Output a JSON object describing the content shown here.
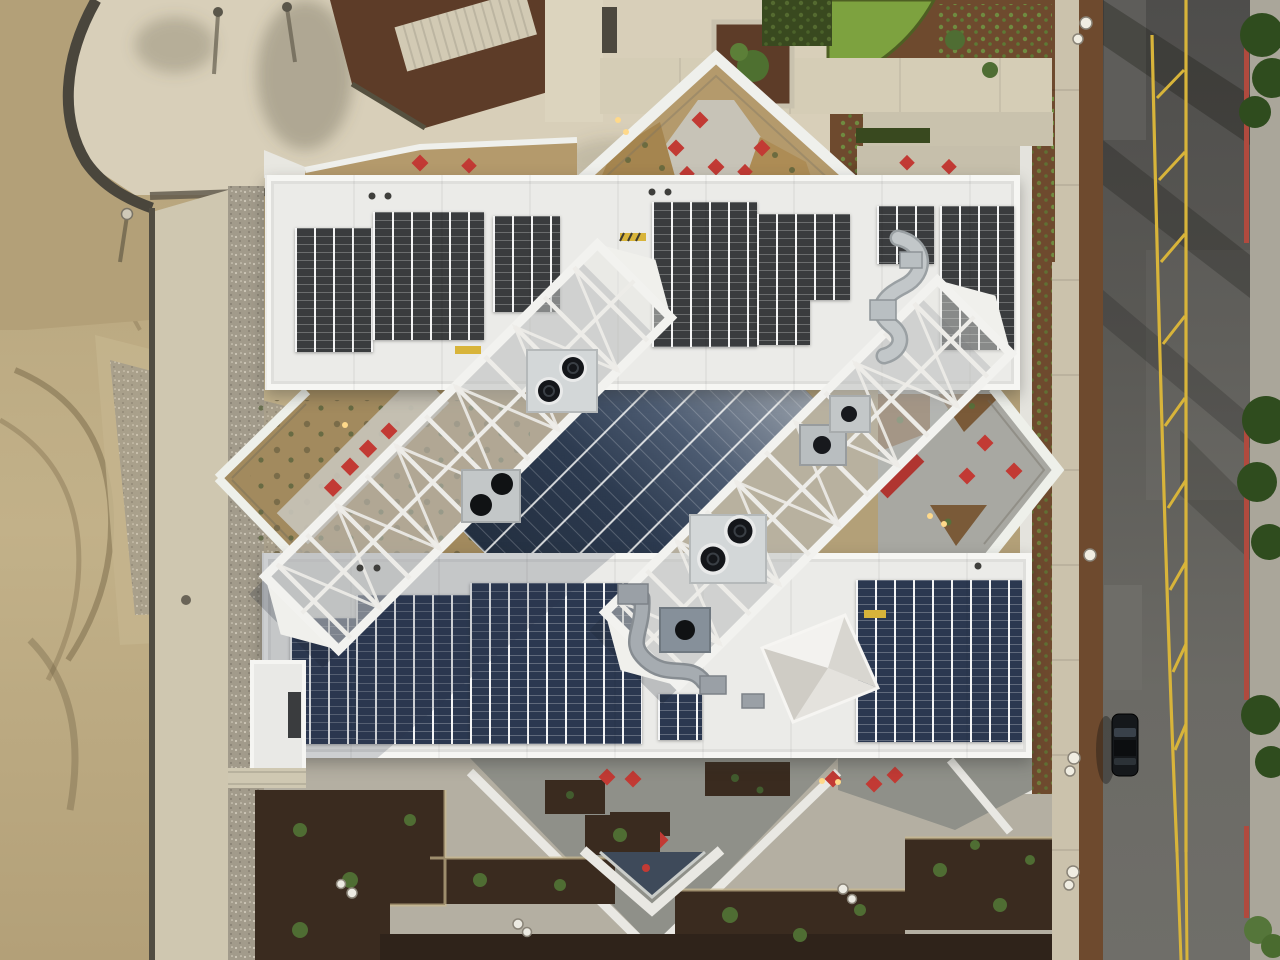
{
  "meta": {
    "type": "aerial-photograph",
    "subject": "Top-down drone photo of a white office building rooftop with solar panel arrays, two diagonal rooftop trusses over a dark glass atrium, landscaped terraces with red umbrellas, a dirt construction lot on the left and a street with yellow median markings and one parked dark car on the right",
    "view": "nadir (straight down)"
  },
  "palette": {
    "dirt": "#b3a078",
    "dirtLight": "#c2b189",
    "wall": "#4a463c",
    "plaza": "#d8cfb9",
    "plazaDusk": "#b4afa2",
    "walk": "#cfc7b0",
    "walk2": "#cbc2ac",
    "gravel": "#a29b8b",
    "mulch": "#5d3c28",
    "mulch2": "#6e4a2e",
    "mulchDusk": "#3a2b1f",
    "lawn": "#7da23f",
    "hedge": "#39491f",
    "tree": "#2f4c1e",
    "tree2": "#4e7030",
    "shrub": "#4f6d33",
    "road1": "#4e4d4b",
    "road2": "#6b6a65",
    "yellow": "#d8b43a",
    "curb": "#b04a3e",
    "roof": "#ebebe8",
    "roofEdge": "#f6f6f3",
    "panelDark": "#3a3c3e",
    "panelBlue": "#2b3850",
    "glass1": "#232f40",
    "glass2": "#2c3a4f",
    "glass3": "#4d5c72",
    "glass4": "#99a1ab",
    "truss": "#f2f2ef",
    "lattice": "#edece8",
    "platform": "#d3d7d8",
    "fan": "#14161a",
    "fanRing": "#e9eaea",
    "red": "#c23a34",
    "redDark": "#b03530",
    "terraceTan": "#b49a6c",
    "terraceGravel": "#a28a5e",
    "pavers": "#a8a8a2",
    "paversDusk": "#8f9089",
    "warm": "#ffd98a",
    "car": "#15181b"
  },
  "features": [
    {
      "name": "construction-dirt-lot",
      "note": "tan graded earth with tire tracks and gravel piles, left side"
    },
    {
      "name": "curved-retaining-wall",
      "note": "dark wall between plaza and dirt, top left"
    },
    {
      "name": "upper-rooftop-solar-array",
      "note": "dark gray photovoltaic columns on white roof"
    },
    {
      "name": "lower-rooftop-solar-array",
      "note": "blue photovoltaic columns with diagonal shadow"
    },
    {
      "name": "diagonal-roof-trusses",
      "note": "two parallel white lattice trusses at 45 degrees with exhaust fans"
    },
    {
      "name": "glass-atrium-roof",
      "note": "dark blue glazed roof with diagonal mullions between trusses"
    },
    {
      "name": "roof-terraces",
      "note": "triangular and diamond terraces with red umbrellas and planting"
    },
    {
      "name": "pyramid-skylight",
      "note": "white pyramidal canopy on lower roof"
    },
    {
      "name": "street",
      "note": "asphalt road with yellow median hatching, double yellow line, red curb"
    },
    {
      "name": "parked-car",
      "note": "single dark vehicle in left lane"
    },
    {
      "name": "lawn-and-gardens",
      "note": "green lawn patch and mulched groundcover beds, top right"
    }
  ]
}
